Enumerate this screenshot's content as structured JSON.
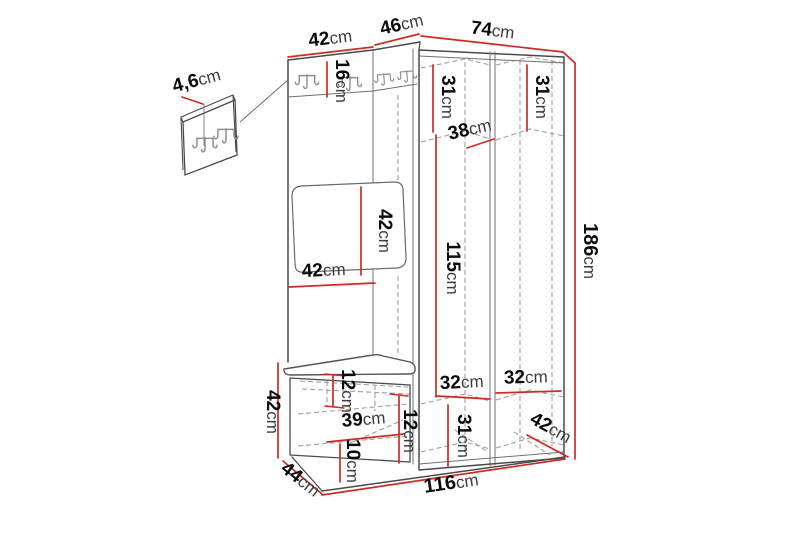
{
  "diagram": {
    "type": "furniture-dimension-drawing",
    "subject": "hallway-unit-with-hooks-mirror-bench-and-wardrobe",
    "unit": "cm",
    "colors": {
      "dimension_line": "#cf2a24",
      "structure_line": "#4a4a4a",
      "hidden_line": "#a0a0a0",
      "label_text": "#0b0b0b",
      "background": "#ffffff"
    },
    "labels": {
      "p46": {
        "value": "4,6",
        "unit": "cm"
      },
      "w42": {
        "value": "42",
        "unit": "cm"
      },
      "w46": {
        "value": "46",
        "unit": "cm"
      },
      "w74": {
        "value": "74",
        "unit": "cm"
      },
      "h16": {
        "value": "16",
        "unit": "cm"
      },
      "d31L": {
        "value": "31",
        "unit": "cm"
      },
      "d31R": {
        "value": "31",
        "unit": "cm"
      },
      "d38": {
        "value": "38",
        "unit": "cm"
      },
      "h42m": {
        "value": "42",
        "unit": "cm"
      },
      "w42s": {
        "value": "42",
        "unit": "cm"
      },
      "h115": {
        "value": "115",
        "unit": "cm"
      },
      "h186": {
        "value": "186",
        "unit": "cm"
      },
      "b42": {
        "value": "42",
        "unit": "cm"
      },
      "b44": {
        "value": "44",
        "unit": "cm"
      },
      "s12": {
        "value": "12",
        "unit": "cm"
      },
      "b39": {
        "value": "39",
        "unit": "cm"
      },
      "b10": {
        "value": "10",
        "unit": "cm"
      },
      "p12": {
        "value": "12",
        "unit": "cm"
      },
      "c32L": {
        "value": "32",
        "unit": "cm"
      },
      "c32R": {
        "value": "32",
        "unit": "cm"
      },
      "c31": {
        "value": "31",
        "unit": "cm"
      },
      "d42": {
        "value": "42",
        "unit": "cm"
      },
      "w116": {
        "value": "116",
        "unit": "cm"
      }
    }
  }
}
